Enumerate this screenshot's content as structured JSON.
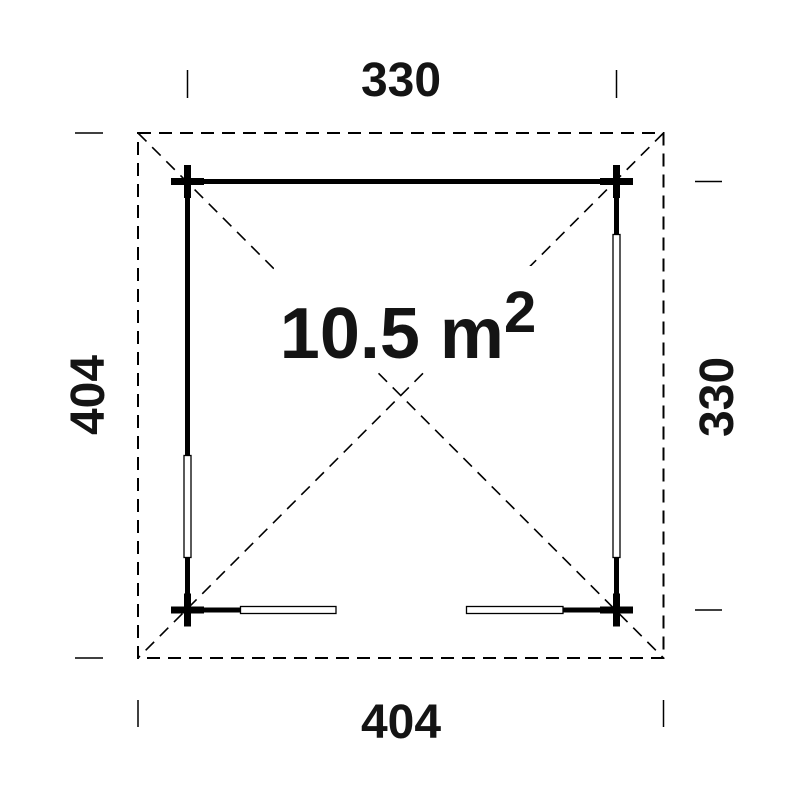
{
  "floor_plan": {
    "type": "garden-house plan view",
    "area": {
      "base": "10.5 m",
      "sup": "2"
    },
    "dimensions": {
      "top": "330",
      "bottom": "404",
      "left": "404",
      "right": "330"
    },
    "colors": {
      "ink": "#141414",
      "line": "#000000",
      "background": "#ffffff"
    }
  }
}
